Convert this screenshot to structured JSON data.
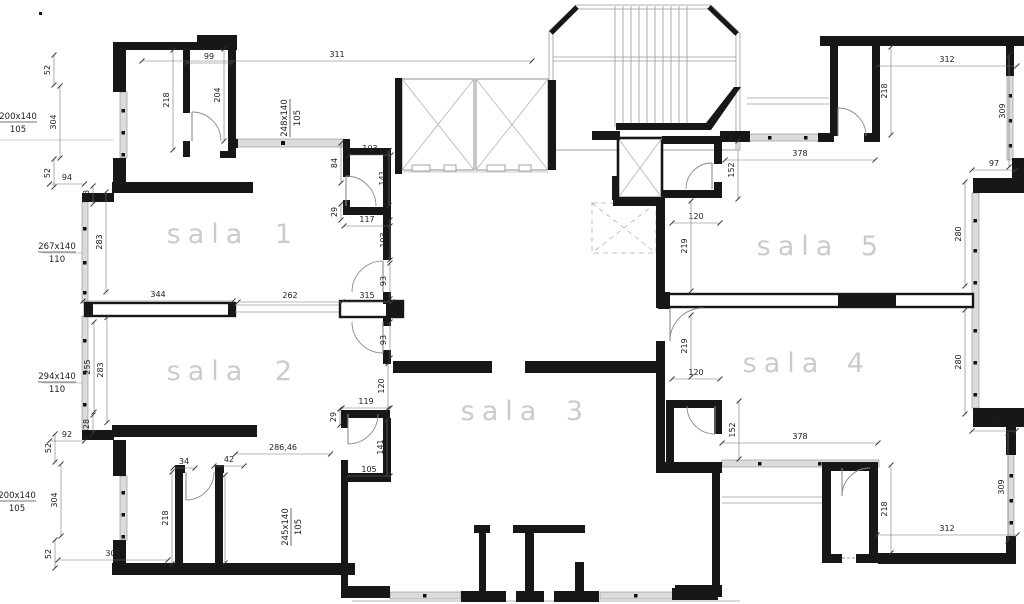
{
  "drawing": {
    "type": "floor-plan",
    "background": "#ffffff",
    "wall_color": "#171717",
    "room_label_color": "#cbcbcb",
    "dim_label_color": "#1c1c1c",
    "window_band_color": "#dcdcdc"
  },
  "rooms": [
    {
      "word": "sala",
      "number": "1",
      "word_x": 208,
      "number_x": 287,
      "y": 243
    },
    {
      "word": "sala",
      "number": "2",
      "word_x": 208,
      "number_x": 287,
      "y": 380
    },
    {
      "word": "sala",
      "number": "3",
      "word_x": 502,
      "number_x": 578,
      "y": 420
    },
    {
      "word": "sala",
      "number": "4",
      "word_x": 784,
      "number_x": 859,
      "y": 372
    },
    {
      "word": "sala",
      "number": "5",
      "word_x": 798,
      "number_x": 873,
      "y": 255
    }
  ],
  "dimensions": [
    {
      "text": "311",
      "x": 337,
      "y": 57,
      "rotate": 0,
      "len": 390
    },
    {
      "text": "99",
      "x": 209,
      "y": 59,
      "rotate": 0,
      "len": 46
    },
    {
      "text": "52",
      "x": 50,
      "y": 70,
      "rotate": 270,
      "len": 30
    },
    {
      "text": "218",
      "x": 169,
      "y": 100,
      "rotate": 270,
      "len": 100
    },
    {
      "text": "204",
      "x": 220,
      "y": 95,
      "rotate": 270,
      "len": 92
    },
    {
      "text": "304",
      "x": 56,
      "y": 122,
      "rotate": 270,
      "len": 72
    },
    {
      "text": "52",
      "x": 50,
      "y": 173,
      "rotate": 270,
      "len": 28
    },
    {
      "text": "94",
      "x": 67,
      "y": 180,
      "rotate": 0,
      "len": 35
    },
    {
      "text": "28",
      "x": 89,
      "y": 195,
      "rotate": 270,
      "len": 18
    },
    {
      "text": "283",
      "x": 102,
      "y": 242,
      "rotate": 270,
      "len": 100
    },
    {
      "text": "344",
      "x": 158,
      "y": 297,
      "rotate": 0,
      "len": 150
    },
    {
      "text": "262",
      "x": 290,
      "y": 298,
      "rotate": 0,
      "len": 104
    },
    {
      "text": "255",
      "x": 90,
      "y": 367,
      "rotate": 270,
      "len": 90
    },
    {
      "text": "283",
      "x": 103,
      "y": 370,
      "rotate": 270,
      "len": 105
    },
    {
      "text": "28",
      "x": 89,
      "y": 424,
      "rotate": 270,
      "len": 18
    },
    {
      "text": "92",
      "x": 67,
      "y": 437,
      "rotate": 0,
      "len": 35
    },
    {
      "text": "52",
      "x": 51,
      "y": 448,
      "rotate": 270,
      "len": 28
    },
    {
      "text": "304",
      "x": 57,
      "y": 500,
      "rotate": 270,
      "len": 72
    },
    {
      "text": "52",
      "x": 51,
      "y": 554,
      "rotate": 270,
      "len": 28
    },
    {
      "text": "307",
      "x": 113,
      "y": 556,
      "rotate": 0,
      "len": 110
    },
    {
      "text": "218",
      "x": 168,
      "y": 518,
      "rotate": 270,
      "len": 92
    },
    {
      "text": "204",
      "x": 221,
      "y": 519,
      "rotate": 270,
      "len": 88
    },
    {
      "text": "34",
      "x": 184,
      "y": 464,
      "rotate": 0,
      "len": 22
    },
    {
      "text": "42",
      "x": 229,
      "y": 462,
      "rotate": 0,
      "len": 30
    },
    {
      "text": "286,46",
      "x": 283,
      "y": 450,
      "rotate": 0,
      "len": 95
    },
    {
      "text": "103",
      "x": 370,
      "y": 151,
      "rotate": 0,
      "len": 42
    },
    {
      "text": "84",
      "x": 337,
      "y": 163,
      "rotate": 270,
      "len": 40
    },
    {
      "text": "141",
      "x": 385,
      "y": 178,
      "rotate": 270,
      "len": 55
    },
    {
      "text": "29",
      "x": 337,
      "y": 212,
      "rotate": 270,
      "len": 16
    },
    {
      "text": "117",
      "x": 367,
      "y": 222,
      "rotate": 0,
      "len": 46
    },
    {
      "text": "103",
      "x": 386,
      "y": 240,
      "rotate": 270,
      "len": 40
    },
    {
      "text": "93",
      "x": 386,
      "y": 281,
      "rotate": 270,
      "len": 36
    },
    {
      "text": "315",
      "x": 367,
      "y": 298,
      "rotate": 0,
      "len": 50
    },
    {
      "text": "93",
      "x": 386,
      "y": 340,
      "rotate": 270,
      "len": 36
    },
    {
      "text": "120",
      "x": 384,
      "y": 386,
      "rotate": 270,
      "len": 45
    },
    {
      "text": "119",
      "x": 366,
      "y": 404,
      "rotate": 0,
      "len": 48
    },
    {
      "text": "29",
      "x": 336,
      "y": 417,
      "rotate": 270,
      "len": 16
    },
    {
      "text": "141",
      "x": 383,
      "y": 447,
      "rotate": 270,
      "len": 55
    },
    {
      "text": "105",
      "x": 369,
      "y": 472,
      "rotate": 0,
      "len": 42
    },
    {
      "text": "152",
      "x": 734,
      "y": 170,
      "rotate": 270,
      "len": 58
    },
    {
      "text": "120",
      "x": 696,
      "y": 219,
      "rotate": 0,
      "len": 48
    },
    {
      "text": "219",
      "x": 687,
      "y": 246,
      "rotate": 270,
      "len": 90
    },
    {
      "text": "219",
      "x": 687,
      "y": 346,
      "rotate": 270,
      "len": 62
    },
    {
      "text": "120",
      "x": 696,
      "y": 375,
      "rotate": 0,
      "len": 48
    },
    {
      "text": "152",
      "x": 735,
      "y": 430,
      "rotate": 270,
      "len": 58
    },
    {
      "text": "378",
      "x": 800,
      "y": 156,
      "rotate": 0,
      "len": 150
    },
    {
      "text": "378",
      "x": 800,
      "y": 439,
      "rotate": 0,
      "len": 156
    },
    {
      "text": "312",
      "x": 947,
      "y": 62,
      "rotate": 0,
      "len": 140
    },
    {
      "text": "218",
      "x": 887,
      "y": 91,
      "rotate": 270,
      "len": 88
    },
    {
      "text": "309",
      "x": 1005,
      "y": 111,
      "rotate": 270,
      "len": 112
    },
    {
      "text": "97",
      "x": 994,
      "y": 166,
      "rotate": 0,
      "len": 44
    },
    {
      "text": "280",
      "x": 961,
      "y": 234,
      "rotate": 270,
      "len": 104
    },
    {
      "text": "280",
      "x": 961,
      "y": 362,
      "rotate": 270,
      "len": 104
    },
    {
      "text": "97",
      "x": 994,
      "y": 427,
      "rotate": 0,
      "len": 44
    },
    {
      "text": "309",
      "x": 1004,
      "y": 487,
      "rotate": 270,
      "len": 108
    },
    {
      "text": "218",
      "x": 887,
      "y": 509,
      "rotate": 270,
      "len": 88
    },
    {
      "text": "312",
      "x": 947,
      "y": 531,
      "rotate": 0,
      "len": 140
    }
  ],
  "window_labels": [
    {
      "top": "200x140",
      "bottom": "105",
      "x": 18,
      "y": 122,
      "rotate": 0
    },
    {
      "top": "267x140",
      "bottom": "110",
      "x": 57,
      "y": 252,
      "rotate": 0
    },
    {
      "top": "294x140",
      "bottom": "110",
      "x": 57,
      "y": 382,
      "rotate": 0
    },
    {
      "top": "200x140",
      "bottom": "105",
      "x": 17,
      "y": 501,
      "rotate": 0
    },
    {
      "top": "248x140",
      "bottom": "105",
      "x": 290,
      "y": 118,
      "rotate": 270
    },
    {
      "top": "245x140",
      "bottom": "105",
      "x": 291,
      "y": 527,
      "rotate": 270
    }
  ]
}
